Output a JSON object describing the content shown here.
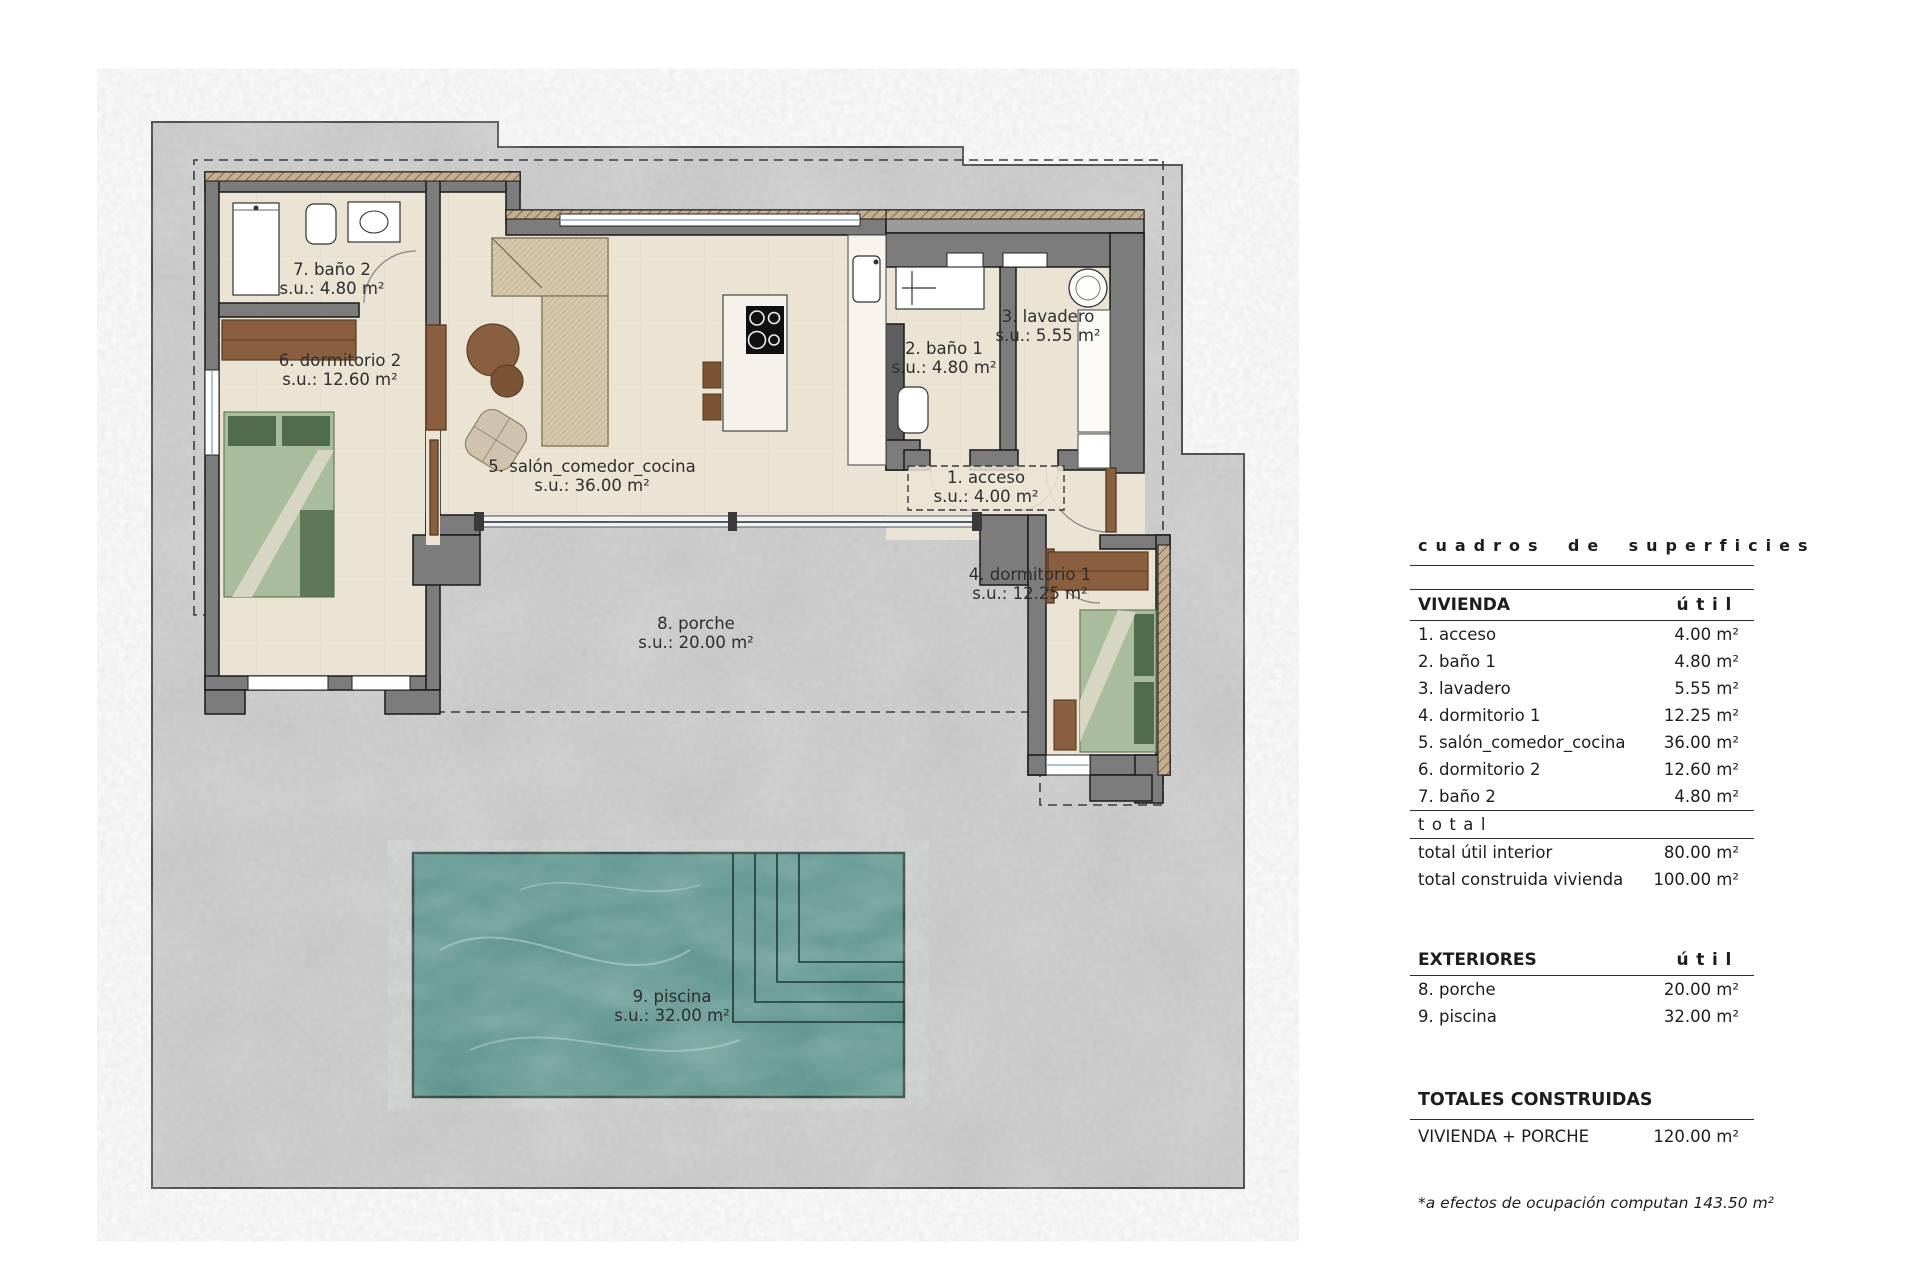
{
  "plan": {
    "rooms": [
      {
        "name": "1. acceso",
        "area": "s.u.: 4.00 m²"
      },
      {
        "name": "2. baño 1",
        "area": "s.u.: 4.80 m²"
      },
      {
        "name": "3. lavadero",
        "area": "s.u.: 5.55 m²"
      },
      {
        "name": "4. dormitorio 1",
        "area": "s.u.: 12.25 m²"
      },
      {
        "name": "5. salón_comedor_cocina",
        "area": "s.u.: 36.00 m²"
      },
      {
        "name": "6. dormitorio 2",
        "area": "s.u.: 12.60 m²"
      },
      {
        "name": "7. baño 2",
        "area": "s.u.: 4.80 m²"
      },
      {
        "name": "8. porche",
        "area": "s.u.: 20.00 m²"
      },
      {
        "name": "9. piscina",
        "area": "s.u.: 32.00 m²"
      }
    ]
  },
  "table": {
    "title": "cuadros de superficies",
    "vivienda": {
      "header": "VIVIENDA",
      "unit_header": "útil",
      "rows": [
        {
          "label": "1. acceso",
          "value": "4.00 m²"
        },
        {
          "label": "2. baño 1",
          "value": "4.80 m²"
        },
        {
          "label": "3. lavadero",
          "value": "5.55 m²"
        },
        {
          "label": "4. dormitorio 1",
          "value": "12.25 m²"
        },
        {
          "label": "5. salón_comedor_cocina",
          "value": "36.00 m²"
        },
        {
          "label": "6. dormitorio 2",
          "value": "12.60 m²"
        },
        {
          "label": "7. baño 2",
          "value": "4.80 m²"
        }
      ],
      "total_label": "total",
      "totals": [
        {
          "label": "total útil interior",
          "value": "80.00 m²"
        },
        {
          "label": "total construida vivienda",
          "value": "100.00 m²"
        }
      ]
    },
    "exteriores": {
      "header": "EXTERIORES",
      "unit_header": "útil",
      "rows": [
        {
          "label": "8. porche",
          "value": "20.00 m²"
        },
        {
          "label": "9. piscina",
          "value": "32.00 m²"
        }
      ]
    },
    "totales": {
      "header": "TOTALES CONSTRUIDAS",
      "rows": [
        {
          "label": "VIVIENDA + PORCHE",
          "value": "120.00 m²"
        }
      ]
    },
    "footnote": "*a efectos de ocupación computan 143.50 m²"
  },
  "colors": {
    "plot_concrete": "#c9c9c9",
    "wall": "#7c7c7c",
    "floor": "#ebe3d4",
    "wood": "#8a5f3f",
    "bed_green": "#a9bc9b",
    "pillow_green": "#506c4a",
    "pool_teal": "#57908a"
  }
}
